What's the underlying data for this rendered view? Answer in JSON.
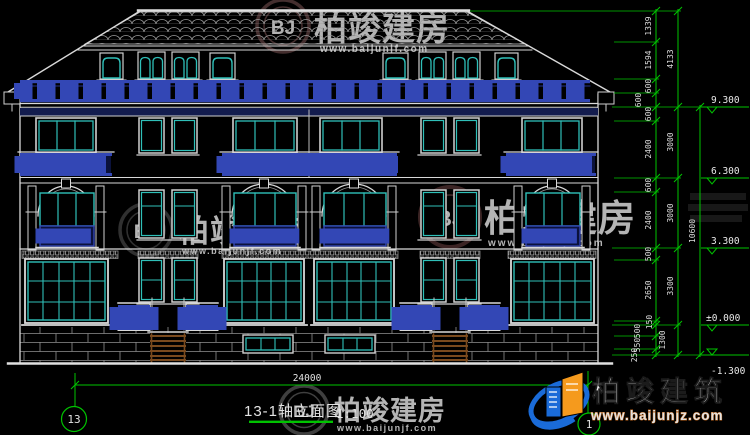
{
  "title": {
    "name": "13-1轴立面图",
    "scale": "1:100"
  },
  "axes": {
    "left": "13",
    "right": "1"
  },
  "dims": {
    "width": "24000",
    "total": "10600",
    "chain1": [
      "1339",
      "1594",
      "600",
      "600",
      "600",
      "2400",
      "600",
      "2400",
      "500",
      "2650",
      "150",
      "500",
      "550",
      "250"
    ],
    "chain2": [
      "4133",
      "3000",
      "3000",
      "3300",
      "1300"
    ]
  },
  "levels": [
    "9.300",
    "6.300",
    "3.300",
    "±0.000",
    "-1.300"
  ],
  "watermark": {
    "brand": "柏竣建房",
    "url": "www.baijunjf.com",
    "monogram": "BJ"
  },
  "logo": {
    "brand": "柏竣建筑",
    "url": "www.baijunjz.com"
  },
  "colors": {
    "line": "#d9d9d9",
    "glass": "#2fbfb8",
    "railing": "#3347b5",
    "dimension": "#00c300",
    "steps": "#7a4a1e",
    "logo_blue": "#1a6bd8",
    "logo_orange": "#f59a1d"
  }
}
